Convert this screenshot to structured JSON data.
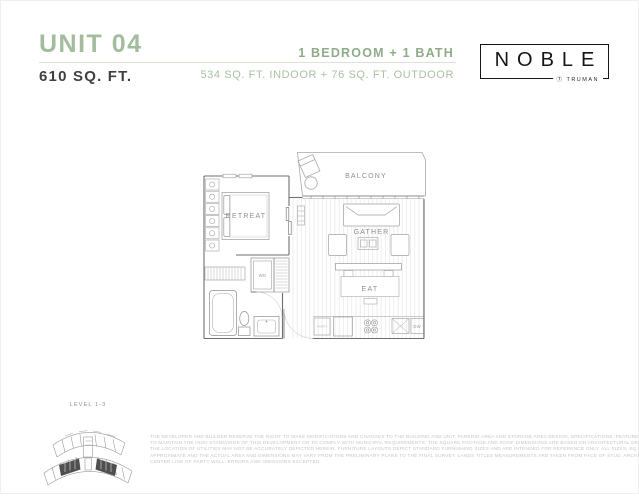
{
  "header": {
    "unit": "UNIT 04",
    "total_area": "610 SQ. FT.",
    "config": "1 BEDROOM + 1 BATH",
    "area_breakdown": "534 SQ. FT. INDOOR + 76 SQ. FT. OUTDOOR"
  },
  "brand": {
    "name": "NOBLE",
    "by_mark": "Ⓣ",
    "by": "TRUMAN"
  },
  "floor_plan": {
    "rooms": {
      "balcony": "BALCONY",
      "retreat": "RETREAT",
      "gather": "GATHER",
      "eat": "EAT"
    },
    "fixtures": {
      "washer_dryer": "WD",
      "dishwasher": "DW",
      "pantry": "PANTRY"
    }
  },
  "key_plan": {
    "label": "LEVEL 1-3"
  },
  "disclaimer": {
    "lines": [
      "THE DEVELOPER AND BUILDER RESERVE THE RIGHT TO MAKE MODIFICATIONS AND CHANGES TO THE BUILDING AND UNIT, PARKING AREA AND STORAGE AREA DESIGN, SPECIFICATIONS, FEATURES AND FLOOR PLANS IN ORDER",
      "TO MAINTAIN THE HIGH STANDARDS OF THIS DEVELOPMENT OR TO COMPLY WITH MUNICIPAL REQUIREMENTS. THE SQUARE FOOTAGE AND ROOF DIMENSIONS ARE BASED ON ARCHITECTURAL DRAWINGS AND MEASUREMENTS.",
      "THE LOCATION OF UTILITIES MAY NOT BE ACCURATELY DEPICTED HEREIN. FURNITURE LAYOUTS DEPICT STANDARD FURNISHING SIZES AND ARE INTENDED FOR REFERENCE ONLY. ALL SIZES, SQ FOOTAGES AND DIMENSIONS ARE",
      "APPROXIMATE AND THE ACTUAL AREA AND DIMENSIONS MAY VARY FROM THE PRELIMINARY PLANS TO THE FINAL SURVEY. LANDS TITLES MEASUREMENTS ARE TAKEN FROM FACE OF STUD. ARCHITECTURAL SIZES ARE TAKEN FROM",
      "CENTER LINE OF PARTY WALL. ERRORS AND OMISSIONS EXCEPTED."
    ]
  },
  "colors": {
    "accent_green": "#a4bc9e",
    "accent_green_dark": "#90ab89",
    "accent_green_light": "#a9c1a3",
    "ink": "#3f3f3f",
    "logo_ink": "#151515",
    "plan_wall": "#6f6f6f",
    "plan_line": "#919191",
    "muted_gray": "#c5c5c5"
  }
}
